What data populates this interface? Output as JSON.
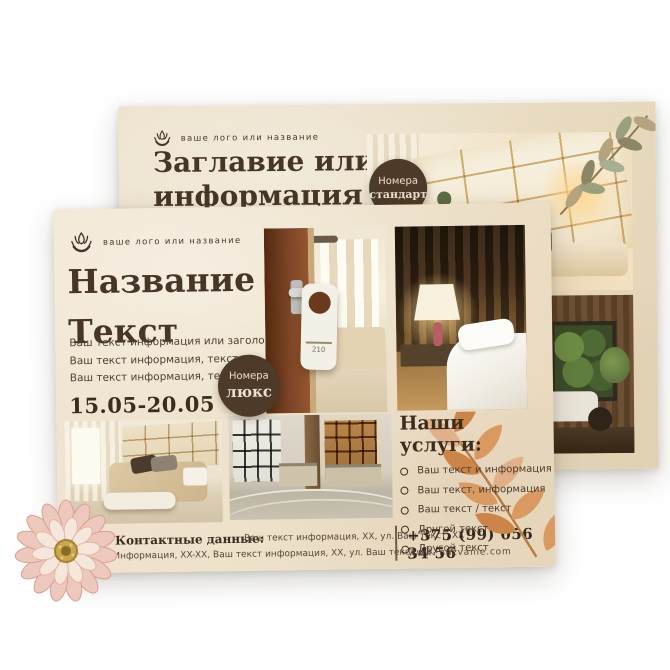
{
  "back": {
    "logo_text": "ваше лого или название",
    "heading_line1": "Заглавие илиБ",
    "heading_line2": "информация",
    "badge": {
      "line1": "Номера",
      "line2": "стандарт"
    }
  },
  "front": {
    "logo_text": "ваше лого или название",
    "heading_line1": "Название",
    "heading_line2": "Текст",
    "body_lines": [
      "Ваш текст информация или заголовок.",
      "Ваш текст информация, текст",
      "Ваш текст информация, текст"
    ],
    "dates": "15.05-20.05",
    "badge": {
      "line1": "Номера",
      "line2": "люкс"
    },
    "door_tag_number": "210",
    "services": {
      "title": "Наши услуги:",
      "items": [
        "Ваш текст и информация",
        "Ваш текст, информация",
        "Ваш текст / текст",
        "Другой текст",
        "Другой текст"
      ]
    },
    "contacts": {
      "label": "Контактные данные:",
      "line1": "Ваш текст информация, XX, ул. Ваш текст, XX",
      "line2": "Информация, XX-XX, Ваш текст информация, XX, ул. Ваш текст, XX,",
      "phone": "+375 (99) 056 34 56",
      "website": "www. nazvanie.com"
    }
  },
  "colors": {
    "paper": "#efe3cf",
    "ink": "#463527",
    "badge": "#4e3a29",
    "leaf_accent": "#c98a4e"
  }
}
